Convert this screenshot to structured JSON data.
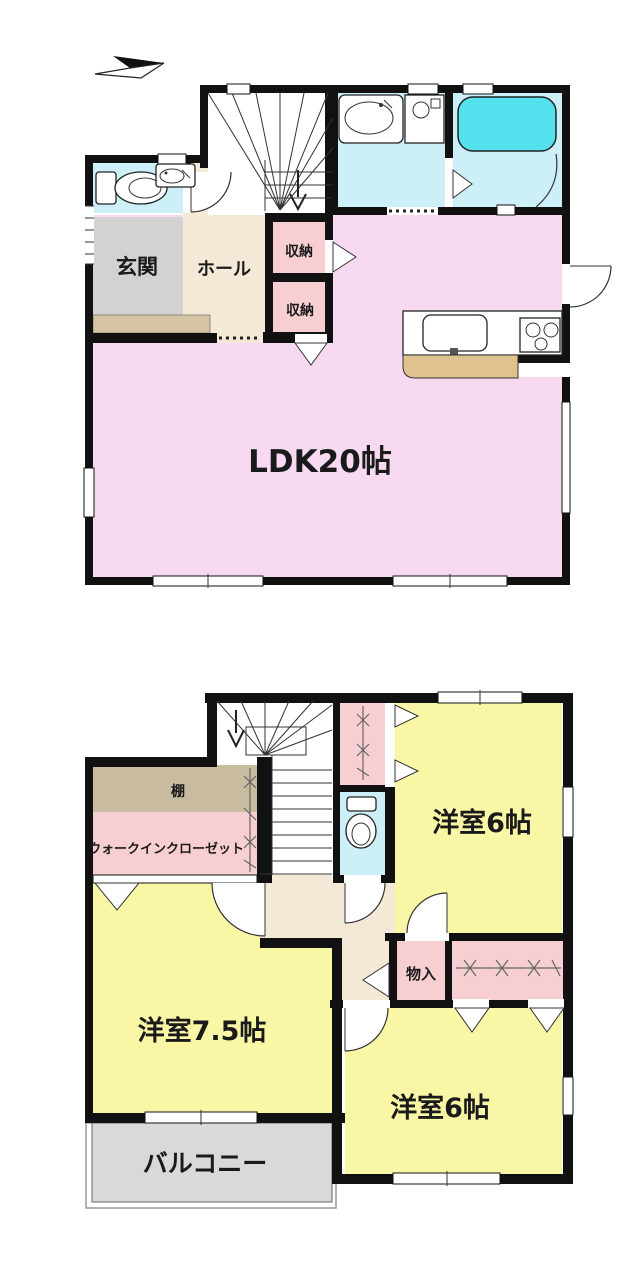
{
  "page": {
    "type": "floor-plan",
    "background": "#ffffff"
  },
  "colors": {
    "wall": "#111111",
    "ldk_pink": "#f8d9f2",
    "closet_pink": "#f7cfd2",
    "room_yellow": "#f9f7a6",
    "wet_cyan": "#cdeff8",
    "bathtub_cyan": "#55e2ef",
    "hall_cream": "#f3e9d6",
    "entrance_gray": "#d2d2d2",
    "step_beige": "#d5c5a5",
    "shelf_tan": "#c9bba0",
    "counter_tan": "#dfc28e",
    "balcony_gray": "#d9d9d9"
  },
  "floor1": {
    "entrance_label": "玄関",
    "hall_label": "ホール",
    "storage1_label": "収納",
    "storage2_label": "収納",
    "ldk_label": "LDK20帖"
  },
  "floor2": {
    "shelf_label": "棚",
    "wic_label": "ウォークインクローゼット",
    "storage_label": "物入",
    "room_ne_label": "洋室6帖",
    "room_w_label": "洋室7.5帖",
    "room_se_label": "洋室6帖",
    "balcony_label": "バルコニー"
  }
}
